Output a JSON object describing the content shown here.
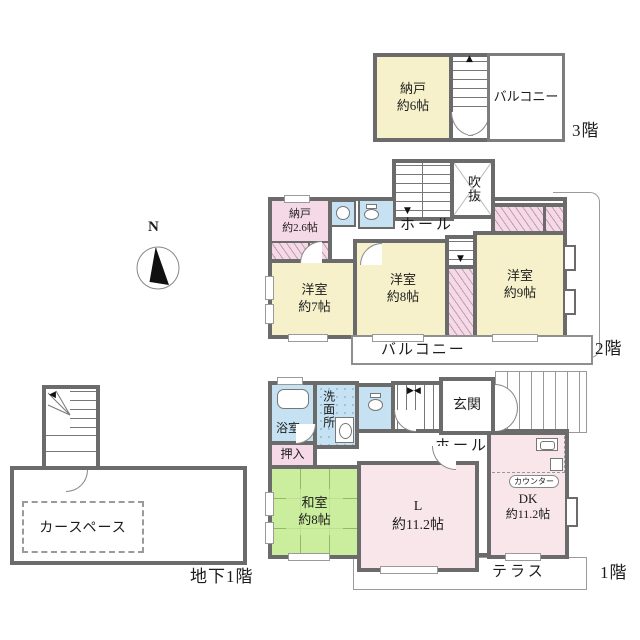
{
  "compass": {
    "label": "N"
  },
  "floors": {
    "f3": {
      "floor_label": "3階",
      "storage": {
        "name": "納戸",
        "size": "約6帖"
      },
      "balcony_label": "バルコニー"
    },
    "f2": {
      "floor_label": "2階",
      "storage": {
        "name": "納戸",
        "size": "約2.6帖"
      },
      "void_label": "吹抜",
      "hall_label": "ホール",
      "western1": {
        "name": "洋室",
        "size": "約7帖"
      },
      "western2": {
        "name": "洋室",
        "size": "約8帖"
      },
      "western3": {
        "name": "洋室",
        "size": "約9帖"
      },
      "balcony_label": "バルコニー"
    },
    "f1": {
      "floor_label": "1階",
      "bath_label": "浴室",
      "washroom_label": "洗面所",
      "entrance_label": "玄関",
      "hall_label": "ホール",
      "closet_label": "押入",
      "japanese_room": {
        "name": "和室",
        "size": "約8帖"
      },
      "living": {
        "name": "L",
        "size": "約11.2帖"
      },
      "dining_kitchen": {
        "name": "DK",
        "size": "約11.2帖"
      },
      "counter_label": "カウンター",
      "terrace_label": "テラス"
    },
    "b1": {
      "floor_label": "地下1階",
      "car_space_label": "カースペース"
    }
  },
  "colors": {
    "wall": "#6b6b6b",
    "room_cream": "#f6f1cb",
    "room_pink": "#f6d9e6",
    "room_pink_light": "#f8e6ea",
    "room_green": "#cbee9e",
    "room_blue": "#c5e1f2",
    "outline": "#9a9a9a"
  }
}
